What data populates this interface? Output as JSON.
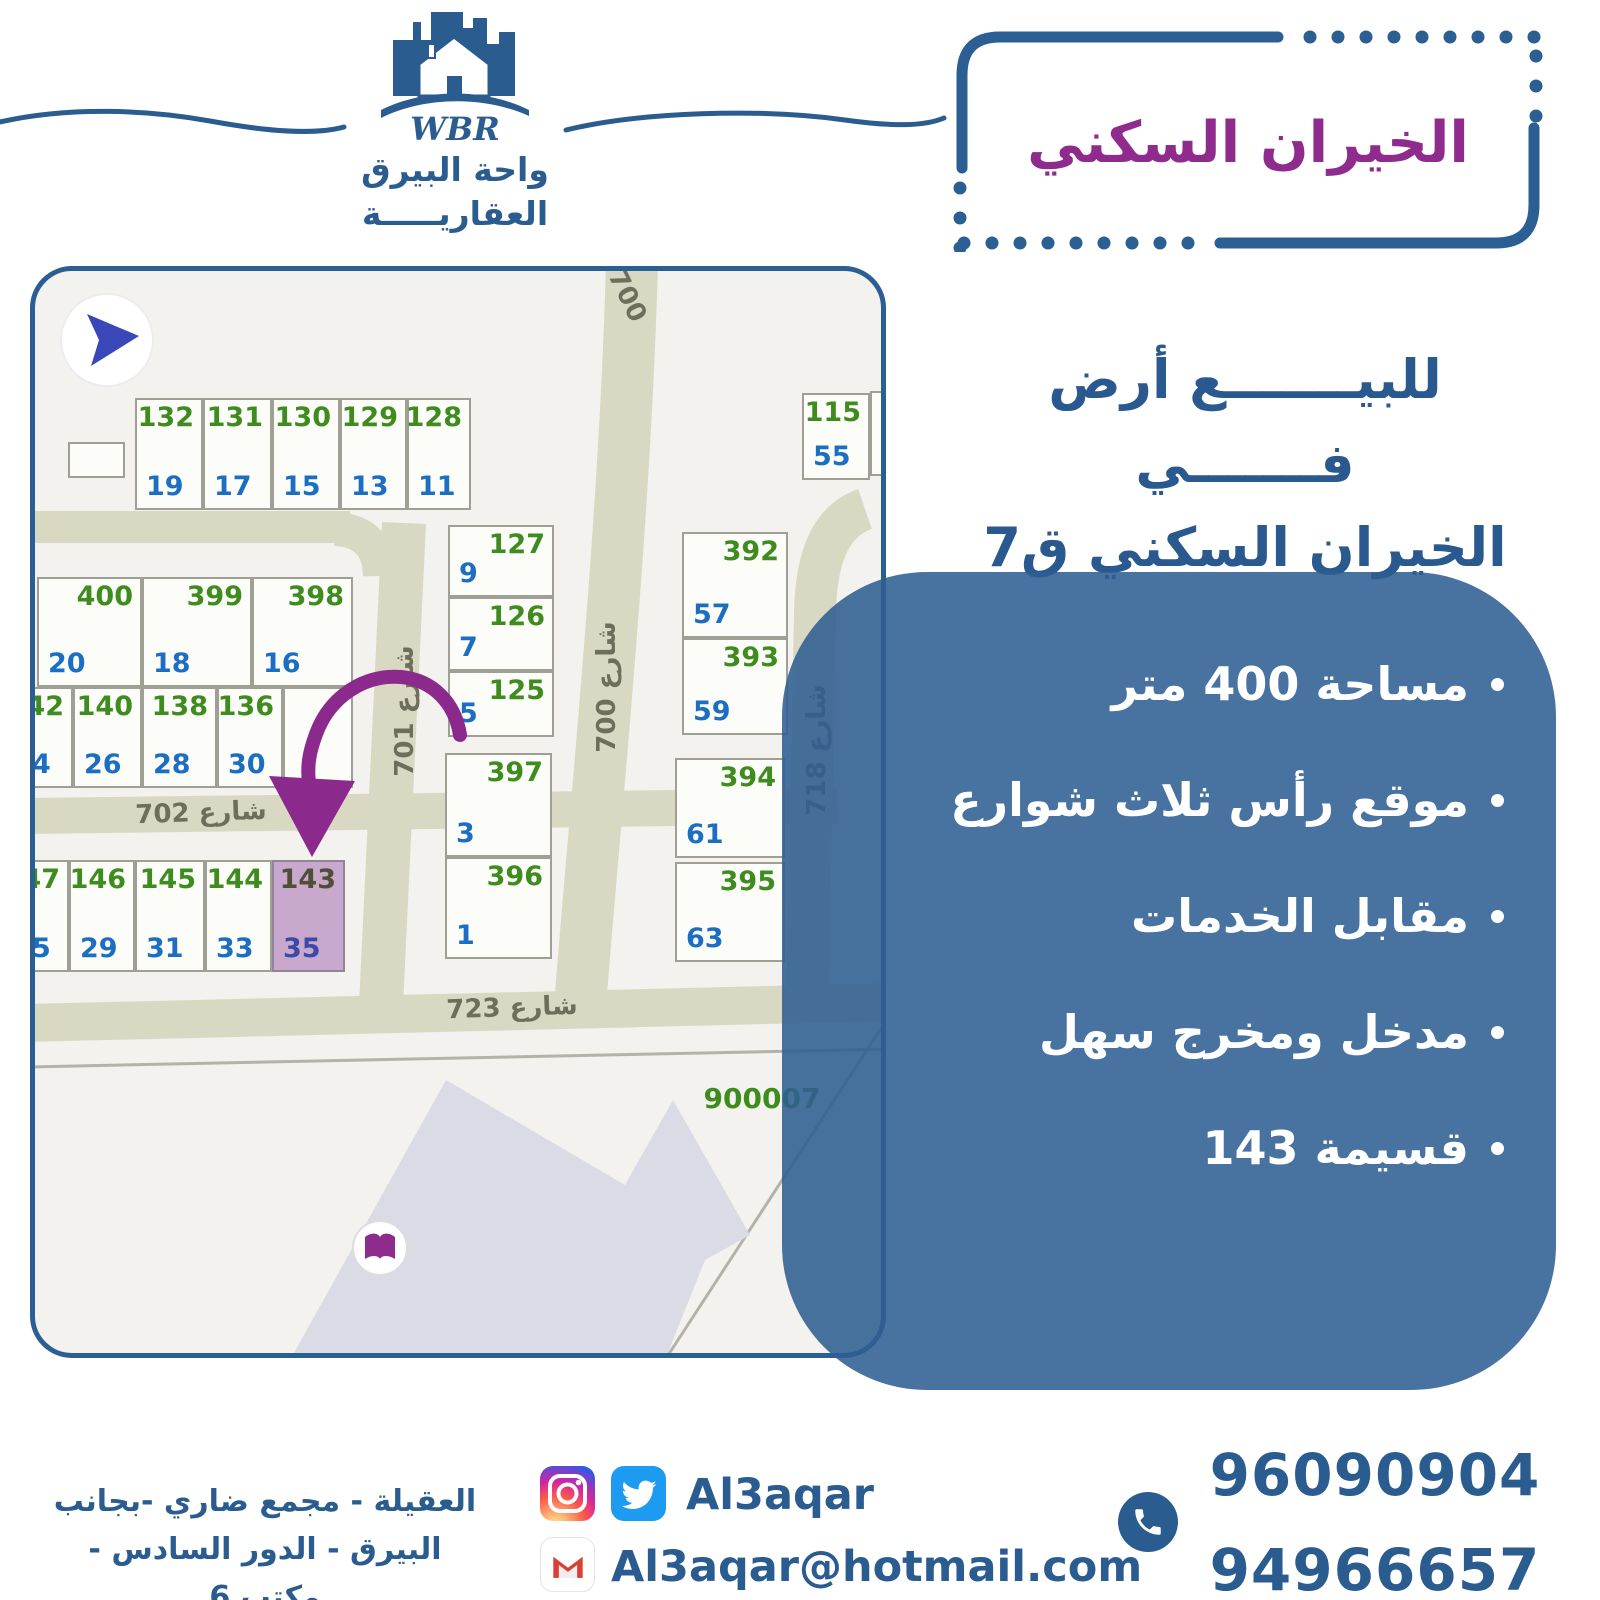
{
  "brand": {
    "wbr": "WBR",
    "name_line1": "واحة البيرق",
    "name_line2": "العقاريـــــة"
  },
  "header": {
    "title": "الخيران السكني",
    "subtitle_line1": "للبيـــــــع أرض فـــــــي",
    "subtitle_line2": "الخيران السكني ق7"
  },
  "panel": {
    "bullets": [
      "مساحة 400 متر",
      "موقع رأس ثلاث شوارع",
      "مقابل الخدمات",
      "مدخل ومخرج سهل",
      "قسيمة 143"
    ]
  },
  "map": {
    "block_number": "900007",
    "street_labels": [
      {
        "t": "700",
        "x": 557,
        "y": 10,
        "w": 70,
        "rot": 64
      },
      {
        "t": "شارع 700",
        "x": 497,
        "y": 401,
        "w": 150,
        "rot": -90
      },
      {
        "t": "شارع 701",
        "x": 295,
        "y": 425,
        "w": 150,
        "rot": -90
      },
      {
        "t": "شارع 718",
        "x": 707,
        "y": 464,
        "w": 150,
        "rot": -90
      },
      {
        "t": "شارع 702",
        "x": 86,
        "y": 527,
        "w": 160,
        "rot": -2
      },
      {
        "t": "شارع 723",
        "x": 397,
        "y": 722,
        "w": 160,
        "rot": -2
      },
      {
        "t": "900007",
        "x": 647,
        "y": 811,
        "w": 160,
        "rot": 0,
        "green": true
      }
    ],
    "plots": [
      {
        "g": "132",
        "b": "19",
        "x": 100,
        "y": 127,
        "w": 68,
        "h": 112
      },
      {
        "g": "131",
        "b": "17",
        "x": 168,
        "y": 127,
        "w": 69,
        "h": 112
      },
      {
        "g": "130",
        "b": "15",
        "x": 237,
        "y": 127,
        "w": 68,
        "h": 112
      },
      {
        "g": "129",
        "b": "13",
        "x": 305,
        "y": 127,
        "w": 67,
        "h": 112
      },
      {
        "g": "128",
        "b": "11",
        "x": 372,
        "y": 127,
        "w": 64,
        "h": 112
      },
      {
        "g": "",
        "b": "",
        "x": 33,
        "y": 171,
        "w": 57,
        "h": 36
      },
      {
        "g": "400",
        "b": "20",
        "x": 2,
        "y": 306,
        "w": 105,
        "h": 110
      },
      {
        "g": "399",
        "b": "18",
        "x": 107,
        "y": 306,
        "w": 110,
        "h": 110
      },
      {
        "g": "398",
        "b": "16",
        "x": 217,
        "y": 306,
        "w": 101,
        "h": 110
      },
      {
        "g": "142",
        "b": "4",
        "x": -14,
        "y": 416,
        "w": 52,
        "h": 101
      },
      {
        "g": "140",
        "b": "26",
        "x": 38,
        "y": 416,
        "w": 69,
        "h": 101
      },
      {
        "g": "138",
        "b": "28",
        "x": 107,
        "y": 416,
        "w": 75,
        "h": 101
      },
      {
        "g": "136",
        "b": "30",
        "x": 182,
        "y": 416,
        "w": 66,
        "h": 101
      },
      {
        "g": "",
        "b": "",
        "x": 248,
        "y": 416,
        "w": 70,
        "h": 101
      },
      {
        "g": "127",
        "b": "9",
        "x": 413,
        "y": 254,
        "w": 106,
        "h": 72
      },
      {
        "g": "126",
        "b": "7",
        "x": 413,
        "y": 326,
        "w": 106,
        "h": 74
      },
      {
        "g": "125",
        "b": "5",
        "x": 413,
        "y": 400,
        "w": 106,
        "h": 66
      },
      {
        "g": "397",
        "b": "3",
        "x": 410,
        "y": 482,
        "w": 107,
        "h": 104
      },
      {
        "g": "396",
        "b": "1",
        "x": 410,
        "y": 586,
        "w": 107,
        "h": 102
      },
      {
        "g": "392",
        "b": "57",
        "x": 647,
        "y": 261,
        "w": 106,
        "h": 106
      },
      {
        "g": "393",
        "b": "59",
        "x": 647,
        "y": 367,
        "w": 106,
        "h": 97
      },
      {
        "g": "394",
        "b": "61",
        "x": 640,
        "y": 487,
        "w": 110,
        "h": 100
      },
      {
        "g": "395",
        "b": "63",
        "x": 640,
        "y": 591,
        "w": 110,
        "h": 100
      },
      {
        "g": "115",
        "b": "55",
        "x": 767,
        "y": 122,
        "w": 68,
        "h": 87
      },
      {
        "g": "",
        "b": "",
        "x": 835,
        "y": 120,
        "w": 46,
        "h": 85
      },
      {
        "g": "47",
        "b": "5",
        "x": -14,
        "y": 589,
        "w": 48,
        "h": 112
      },
      {
        "g": "146",
        "b": "29",
        "x": 34,
        "y": 589,
        "w": 66,
        "h": 112
      },
      {
        "g": "145",
        "b": "31",
        "x": 100,
        "y": 589,
        "w": 70,
        "h": 112
      },
      {
        "g": "144",
        "b": "33",
        "x": 170,
        "y": 589,
        "w": 67,
        "h": 112
      },
      {
        "g": "143",
        "b": "35",
        "x": 237,
        "y": 589,
        "w": 73,
        "h": 112,
        "hl": true
      }
    ]
  },
  "footer": {
    "address_line1": "العقيلة - مجمع ضاري -بجانب",
    "address_line2": "البيرق - الدور السادس - مكتب 6",
    "social_handle": "Al3aqar",
    "email": "Al3aqar@hotmail.com",
    "phone1": "96090904",
    "phone2": "94966657"
  },
  "colors": {
    "dark_blue": "#2b5c90",
    "purple": "#8e2b8d",
    "panel_blue": "#4a77a6",
    "plot_green": "#3f8c1e",
    "plot_blue": "#1b6ec2",
    "street": "#d9d9c3",
    "highlight_plot": "#c8a9cd",
    "arrow_purple": "#8b2a8c",
    "twitter_blue": "#1d9bf0"
  }
}
